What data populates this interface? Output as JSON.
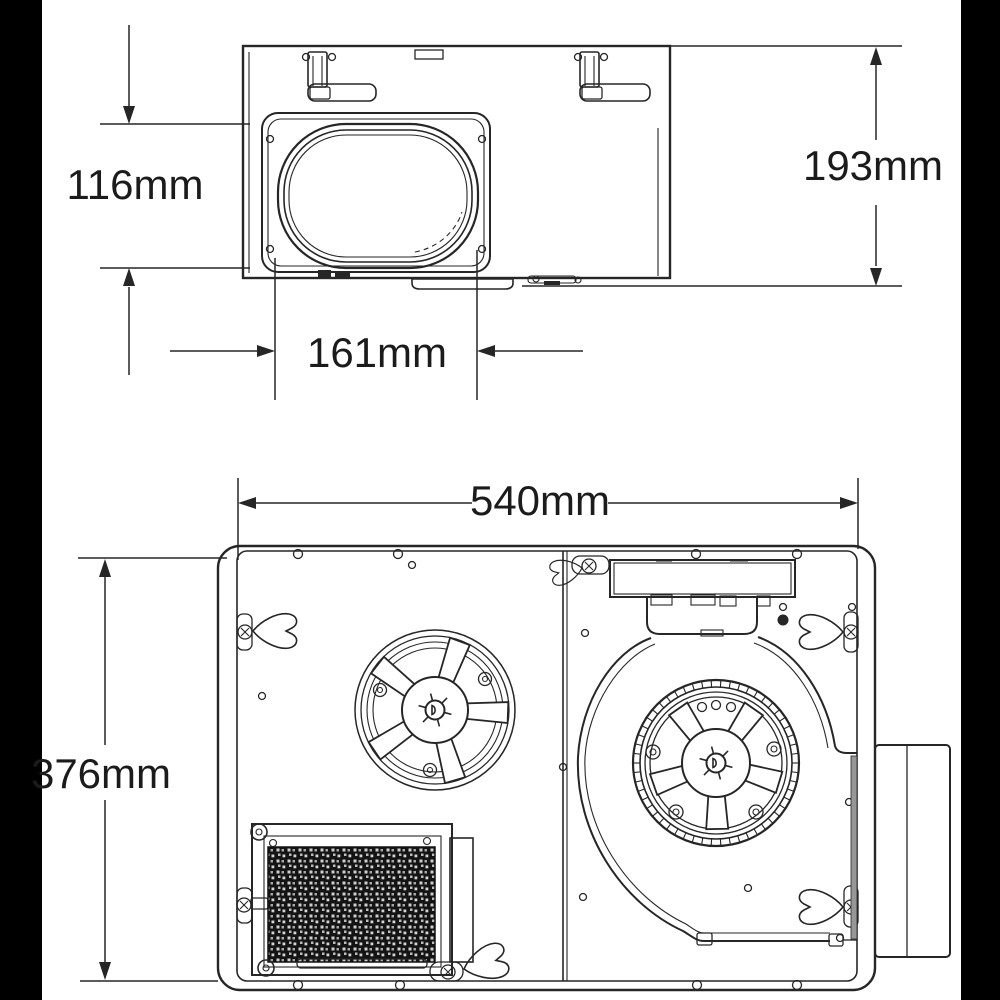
{
  "diagram": {
    "dimensions": {
      "duct_opening_height": "116mm",
      "housing_height": "193mm",
      "duct_opening_width": "161mm",
      "housing_width": "540mm",
      "housing_depth": "376mm"
    },
    "colors": {
      "line": "#262626",
      "background": "#ffffff",
      "photo_edge_band": "#000000",
      "filter_mesh": "#141414"
    }
  }
}
